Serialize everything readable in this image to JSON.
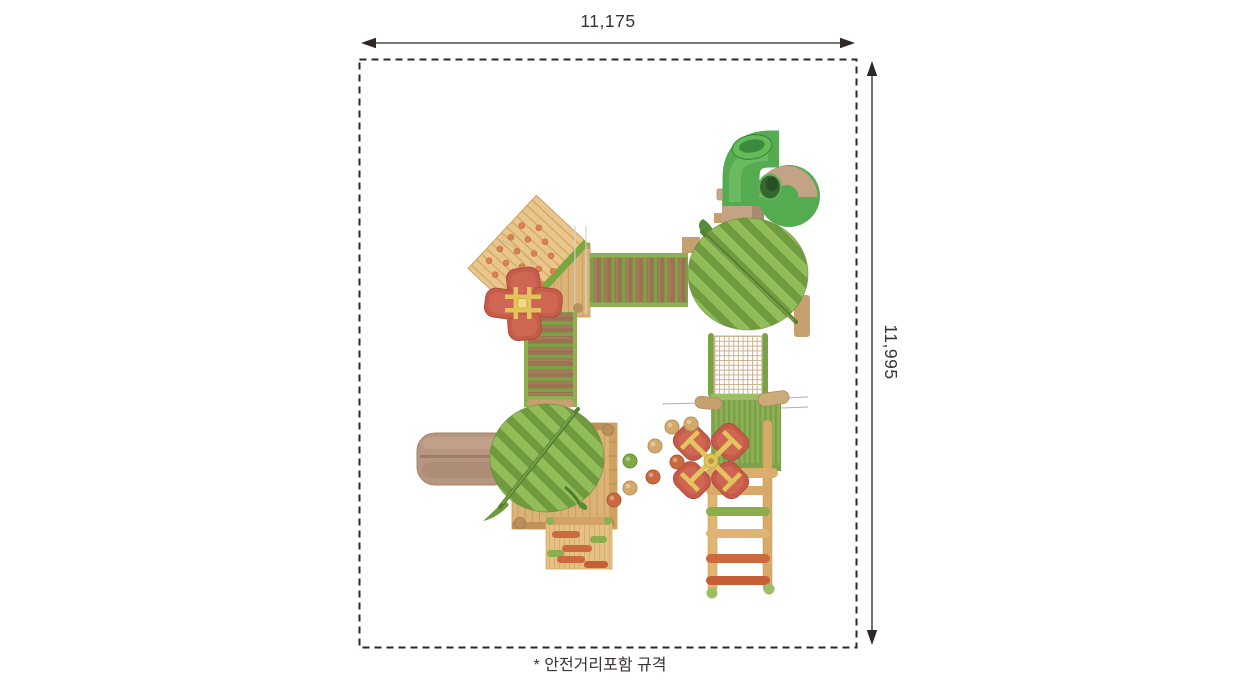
{
  "labels": {
    "width_dimension": "11,175",
    "height_dimension": "11,995",
    "footnote": "* 안전거리포함 규격"
  },
  "palette": {
    "line": "#2e2724",
    "text": "#3a332e",
    "wood_plank": "#dcb377",
    "wood_line": "#c49a5e",
    "wood_dark": "#b68a52",
    "wood_pale": "#e6c183",
    "wood_pale_line": "#d2a967",
    "bridge_green": "#7aa444",
    "bridge_green_light": "#8db053",
    "plank_brown": "#9b7352",
    "plank_brown_grain": "#a87f5c",
    "leaf_base": "#7ea849",
    "leaf_light": "#93bd58",
    "leaf_mid": "#6f9a3e",
    "leaf_vein": "#567f31",
    "leaf_vein_light": "#7fa64a",
    "tube_green": "#55ab50",
    "tube_green_light": "#74c268",
    "tube_green_dark": "#3c8a3e",
    "tube_cap": "#63bb58",
    "tan": "#c2a385",
    "tan_dark": "#a98a6e",
    "tan_log": "#c7a070",
    "slide_tan": "#b79680",
    "slide_tan_dark": "#a8876f",
    "net_line": "#cbb391",
    "panel_green": "#8cb054",
    "panel_rib": "#7a9e47",
    "panel_band": "#9cbf63",
    "ladder_wood": "#dcae6e",
    "ladder_wood_light": "#e0b473",
    "rung_tan": "#d9a967",
    "rung_green": "#8aae4c",
    "rung_orange": "#cc6a3e",
    "rung_orange_dark": "#c65f36",
    "flower_red": "#c75b49",
    "flower_red_dark": "#b04c3c",
    "flower_red_light": "#d4705c",
    "flower_yellow": "#e3c35c",
    "flower_yellow_dark": "#c9a93f",
    "flower_yellow_light": "#eed984",
    "ball_tan": "#d4a96c",
    "ball_green": "#7fa845",
    "ball_orange": "#c96a3e",
    "hold_orange": "#d9814f",
    "gray_line": "#b3ada6",
    "pole_light": "#d8d2c8",
    "diamond_wood": "#e9c68c",
    "diamond_wood_line": "#d6ab69",
    "diamond_green_edge": "#7aa73f",
    "foot_green": "#9dbf63"
  },
  "playground_parts": [
    "corkscrew-tube-slide",
    "leaf-canopy-right",
    "leaf-canopy-left",
    "diamond-climbing-wall",
    "horizontal-log-bridge",
    "vertical-log-bridge",
    "flower-spinner-upper-left",
    "flower-spinner-right",
    "climbing-net",
    "ribbed-green-panel",
    "wooden-rung-ladder",
    "straight-slide-left",
    "wooden-platform-upper",
    "wooden-platform-lower",
    "step-climber-bottom",
    "scattered-play-balls"
  ]
}
